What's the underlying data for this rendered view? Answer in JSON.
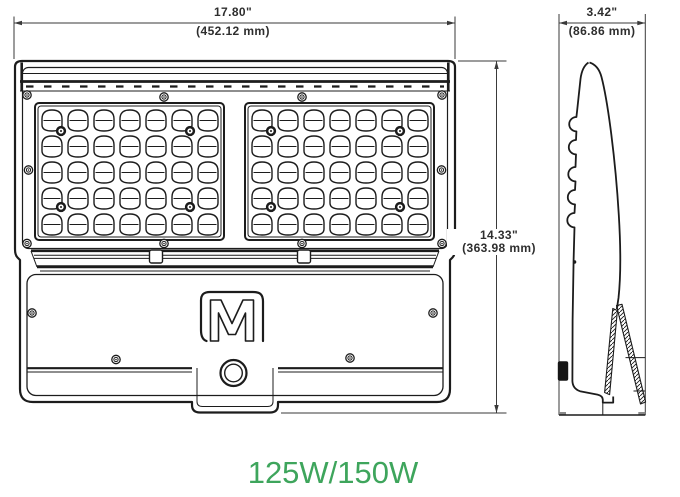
{
  "drawing": {
    "dimensions": {
      "width": {
        "inches": "17.80\"",
        "mm": "(452.12 mm)"
      },
      "height": {
        "inches": "14.33\"",
        "mm": "(363.98 mm)"
      },
      "depth": {
        "inches": "3.42\"",
        "mm": "(86.86 mm)"
      }
    },
    "wattage_label": "125W/150W",
    "logo_letter": "M",
    "led_panels": {
      "count": 2,
      "columns": 7,
      "rows": 5
    },
    "colors": {
      "line": "#1c1c1c",
      "accent_green": "#3ea55c"
    }
  }
}
